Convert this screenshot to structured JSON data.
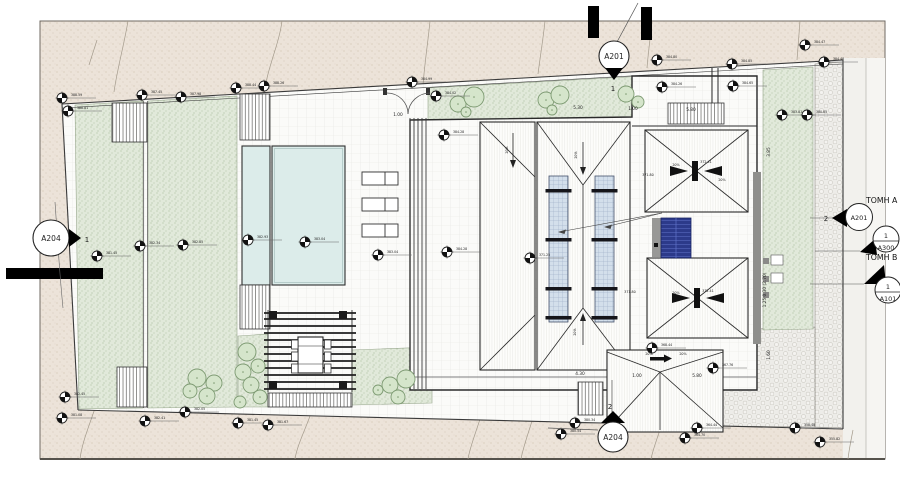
{
  "section_titles": {
    "a": "ΤΟΜΗ A",
    "b": "ΤΟΜΗ Β"
  },
  "markers": {
    "top": {
      "id": "A201",
      "num": "1"
    },
    "left": {
      "id": "A204",
      "num": "1"
    },
    "bottom": {
      "id": "A204",
      "num": "2"
    },
    "right_a201": {
      "id": "A201",
      "num": "2"
    },
    "right_a300": {
      "id": "A300",
      "num": "1"
    },
    "right_a101": {
      "id": "A101",
      "num": "1"
    }
  },
  "colors": {
    "terrain": "#ece3d9",
    "lawn": "#e1e9da",
    "pool": "#dcecea",
    "skylight": "#d3dfeb",
    "solar_panel": "#2c3a8a",
    "gravel": "#edece8",
    "wall_gray": "#8f8f8c",
    "line": "#2a2a2a"
  },
  "dimensions": [
    {
      "x": 578,
      "y": 109,
      "t": "5.30"
    },
    {
      "x": 633,
      "y": 110,
      "t": "1.00"
    },
    {
      "x": 691,
      "y": 111,
      "t": "5.80"
    },
    {
      "x": 398,
      "y": 116,
      "t": "1.00"
    },
    {
      "x": 580,
      "y": 375,
      "t": "4.30"
    },
    {
      "x": 637,
      "y": 377,
      "t": "1.00"
    },
    {
      "x": 697,
      "y": 377,
      "t": "5.80"
    },
    {
      "x": 770,
      "y": 152,
      "t": "3.85",
      "r": -90
    },
    {
      "x": 770,
      "y": 355,
      "t": "1.60",
      "r": -90
    },
    {
      "x": 766,
      "y": 290,
      "t": "1.25 0.30 (2.70)",
      "r": -90
    }
  ],
  "slope_labels": [
    {
      "x": 508,
      "y": 150,
      "t": "20%",
      "r": -90
    },
    {
      "x": 577,
      "y": 155,
      "t": "20%",
      "r": -90
    },
    {
      "x": 576,
      "y": 332,
      "t": "20%",
      "r": -90
    },
    {
      "x": 676,
      "y": 166,
      "t": "20%"
    },
    {
      "x": 722,
      "y": 181,
      "t": "20%"
    },
    {
      "x": 676,
      "y": 294,
      "t": "20%"
    },
    {
      "x": 649,
      "y": 355,
      "t": "20%"
    },
    {
      "x": 683,
      "y": 355,
      "t": "20%"
    }
  ],
  "roof_elevations": [
    {
      "x": 648,
      "y": 176,
      "t": "371.80"
    },
    {
      "x": 706,
      "y": 163,
      "t": "372.41"
    },
    {
      "x": 630,
      "y": 293,
      "t": "371.80"
    },
    {
      "x": 708,
      "y": 292,
      "t": "372.41"
    }
  ],
  "spot_elevations": [
    {
      "x": 62,
      "y": 98,
      "t": "388.59"
    },
    {
      "x": 68,
      "y": 111,
      "t": "388.81"
    },
    {
      "x": 142,
      "y": 95,
      "t": "387.45"
    },
    {
      "x": 181,
      "y": 97,
      "t": "387.98"
    },
    {
      "x": 236,
      "y": 88,
      "t": "388.44"
    },
    {
      "x": 264,
      "y": 86,
      "t": "388.26"
    },
    {
      "x": 412,
      "y": 82,
      "t": "384.99"
    },
    {
      "x": 436,
      "y": 96,
      "t": "384.02"
    },
    {
      "x": 657,
      "y": 60,
      "t": "384.80"
    },
    {
      "x": 732,
      "y": 64,
      "t": "384.85"
    },
    {
      "x": 662,
      "y": 87,
      "t": "384.26"
    },
    {
      "x": 733,
      "y": 86,
      "t": "384.65"
    },
    {
      "x": 805,
      "y": 45,
      "t": "384.47"
    },
    {
      "x": 824,
      "y": 62,
      "t": "384.48"
    },
    {
      "x": 782,
      "y": 115,
      "t": "383.81"
    },
    {
      "x": 807,
      "y": 115,
      "t": "380.85"
    },
    {
      "x": 97,
      "y": 256,
      "t": "381.45"
    },
    {
      "x": 140,
      "y": 246,
      "t": "382.34"
    },
    {
      "x": 183,
      "y": 245,
      "t": "382.85"
    },
    {
      "x": 248,
      "y": 240,
      "t": "382.93"
    },
    {
      "x": 305,
      "y": 242,
      "t": "383.04"
    },
    {
      "x": 378,
      "y": 255,
      "t": "383.04"
    },
    {
      "x": 444,
      "y": 135,
      "t": "384.28"
    },
    {
      "x": 447,
      "y": 252,
      "t": "384.28"
    },
    {
      "x": 530,
      "y": 258,
      "t": "371.25"
    },
    {
      "x": 652,
      "y": 348,
      "t": "368.44"
    },
    {
      "x": 713,
      "y": 368,
      "t": "367.76"
    },
    {
      "x": 65,
      "y": 397,
      "t": "382.45"
    },
    {
      "x": 62,
      "y": 418,
      "t": "381.08"
    },
    {
      "x": 145,
      "y": 421,
      "t": "382.41"
    },
    {
      "x": 185,
      "y": 412,
      "t": "382.05"
    },
    {
      "x": 238,
      "y": 423,
      "t": "381.45"
    },
    {
      "x": 268,
      "y": 425,
      "t": "381.67"
    },
    {
      "x": 561,
      "y": 434,
      "t": "380.54"
    },
    {
      "x": 575,
      "y": 423,
      "t": "380.34"
    },
    {
      "x": 697,
      "y": 428,
      "t": "364.44"
    },
    {
      "x": 685,
      "y": 438,
      "t": "364.70"
    },
    {
      "x": 795,
      "y": 428,
      "t": "358.48"
    },
    {
      "x": 820,
      "y": 442,
      "t": "355.82"
    }
  ],
  "trees": [
    {
      "x": 458,
      "y": 104,
      "r": 8
    },
    {
      "x": 474,
      "y": 97,
      "r": 10
    },
    {
      "x": 466,
      "y": 112,
      "r": 5
    },
    {
      "x": 546,
      "y": 100,
      "r": 8
    },
    {
      "x": 560,
      "y": 95,
      "r": 9
    },
    {
      "x": 552,
      "y": 110,
      "r": 5
    },
    {
      "x": 626,
      "y": 94,
      "r": 8
    },
    {
      "x": 638,
      "y": 102,
      "r": 6
    },
    {
      "x": 247,
      "y": 352,
      "r": 9
    },
    {
      "x": 258,
      "y": 366,
      "r": 7
    },
    {
      "x": 243,
      "y": 372,
      "r": 8
    },
    {
      "x": 251,
      "y": 385,
      "r": 8
    },
    {
      "x": 260,
      "y": 397,
      "r": 7
    },
    {
      "x": 240,
      "y": 402,
      "r": 6
    },
    {
      "x": 197,
      "y": 378,
      "r": 9
    },
    {
      "x": 214,
      "y": 383,
      "r": 8
    },
    {
      "x": 190,
      "y": 391,
      "r": 7
    },
    {
      "x": 207,
      "y": 396,
      "r": 8
    },
    {
      "x": 390,
      "y": 385,
      "r": 8
    },
    {
      "x": 406,
      "y": 379,
      "r": 9
    },
    {
      "x": 398,
      "y": 397,
      "r": 7
    },
    {
      "x": 378,
      "y": 390,
      "r": 5
    }
  ]
}
